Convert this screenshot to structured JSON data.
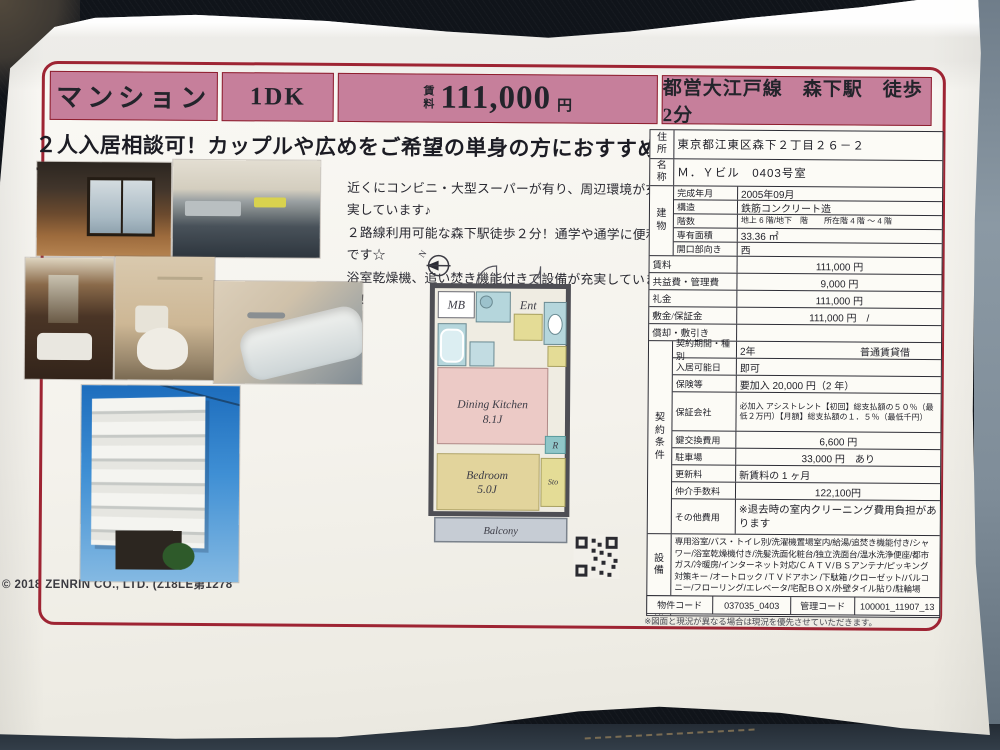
{
  "colors": {
    "band_pink": "#c67f9b",
    "frame_red": "#9e2433",
    "paper": "#f4f2ec"
  },
  "header": {
    "property_type": "マンション",
    "layout": "1DK",
    "rent_label": "賃\n料",
    "rent_value": "111,000",
    "rent_unit": "円",
    "access": "都営大江戸線　森下駅　徒歩 2分"
  },
  "catchphrase": "２人入居相談可！カップルや広めをご希望の単身の方におすすめです",
  "description": {
    "line1": "近くにコンビニ・大型スーパーが有り、周辺環境が充実しています♪",
    "line2": "２路線利用可能な森下駅徒歩２分！通学や通学に便利です☆",
    "line3": "浴室乾燥機、追い焚き機能付きで設備が充実しています！"
  },
  "floorplan": {
    "north": "N",
    "mb": "MB",
    "ent": "Ent",
    "dk": "Dining Kitchen",
    "dk_size": "8.1J",
    "r": "R",
    "bedroom": "Bedroom",
    "bedroom_size": "5.0J",
    "sto": "Sto",
    "balcony": "Balcony"
  },
  "info": {
    "address_label": "住所",
    "address": "東京都江東区森下２丁目２６－２",
    "name_label": "名称",
    "name": "Ｍ．Ｙビル　0403号室",
    "building_label": "建物",
    "building": [
      {
        "label": "完成年月",
        "value": "2005年09月"
      },
      {
        "label": "構造",
        "value": "鉄筋コンクリート造"
      },
      {
        "label": "階数",
        "value": "地上 6 階/地下　階　　所在階 4 階 ～ 4 階"
      },
      {
        "label": "専有面積",
        "value": "33.36 ㎡"
      },
      {
        "label": "開口部向き",
        "value": "西"
      }
    ],
    "money": [
      {
        "label": "賃料",
        "value": "111,000 円"
      },
      {
        "label": "共益費・管理費",
        "value": "9,000 円"
      },
      {
        "label": "礼金",
        "value": "111,000 円"
      },
      {
        "label": "敷金/保証金",
        "value": "111,000 円　/"
      },
      {
        "label": "償却・敷引き",
        "value": ""
      }
    ],
    "contract_label": "契約条件",
    "contract": [
      {
        "label": "契約期間・種別",
        "value": "2年",
        "value2": "普通賃貸借"
      },
      {
        "label": "入居可能日",
        "value": "即可"
      },
      {
        "label": "保険等",
        "value": "要加入 20,000 円（2 年）"
      },
      {
        "label": "保証会社",
        "value": "必加入 アシストレント【初回】総支払額の５０％（最低２万円）【月額】総支払額の１．５％（最低千円）"
      },
      {
        "label": "鍵交換費用",
        "value": "6,600 円"
      },
      {
        "label": "駐車場",
        "value": "33,000 円　あり"
      },
      {
        "label": "更新料",
        "value": "新賃料の 1 ヶ月"
      },
      {
        "label": "仲介手数料",
        "value": "122,100円"
      },
      {
        "label": "その他費用",
        "value": "※退去時の室内クリーニング費用負担があります"
      }
    ],
    "equipment_label": "設備",
    "equipment": "専用浴室/バス・トイレ別/洗濯機置場室内/給湯/追焚き機能付き/シャワー/浴室乾燥機付き/洗髪洗面化粧台/独立洗面台/温水洗浄便座/都市ガス/冷暖房/インターネット対応/ＣＡＴＶ/ＢＳアンテナ/ピッキング対策キー /オートロック /ＴＶドアホン /下駄箱 /クローゼット/バルコニー/フローリング/エレベータ/宅配ＢＯＸ/外壁タイル貼り/駐輪場",
    "feature_label": "特徴",
    "feature": "24時間受付管理/家賃deポイント物件",
    "codes": {
      "property_label": "物件コード",
      "property_value": "037035_0403",
      "mgmt_label": "管理コード",
      "mgmt_value": "100001_11907_13"
    },
    "note": "※図面と現況が異なる場合は現況を優先させていただきます。"
  },
  "copyright": "© 2018 ZENRIN CO., LTD. (Z18LE第1278"
}
